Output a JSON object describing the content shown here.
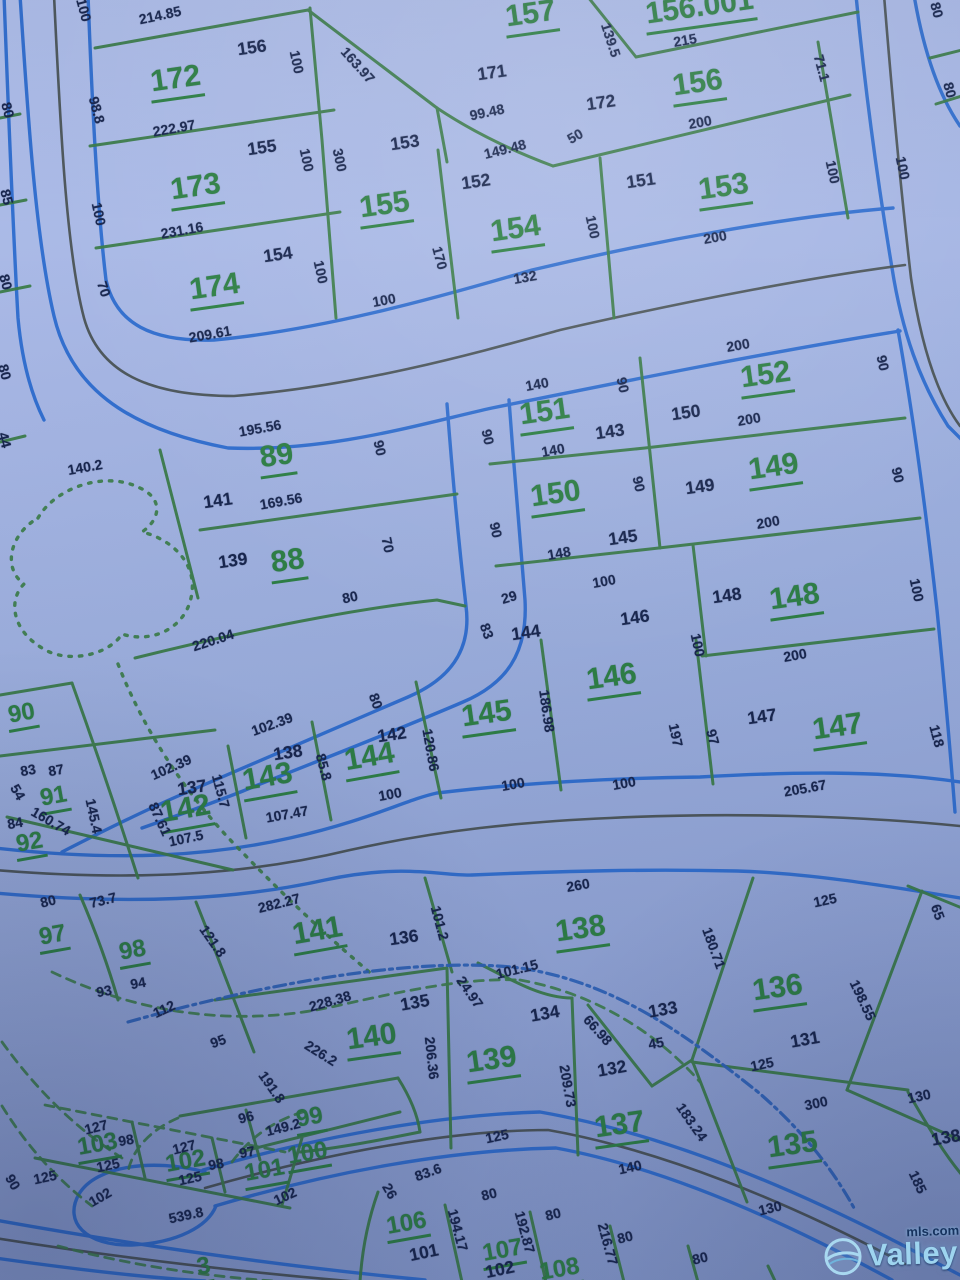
{
  "map": {
    "colors": {
      "background": "#9cafde",
      "lot_line_green": "#3b7c49",
      "road_edge_blue": "#2d6cce",
      "road_centerline_dark": "#454e4d",
      "creek_blue": "#2e63b8",
      "lot_text_green": "#2e8045",
      "dim_text_navy": "#18264e"
    },
    "lots": [
      {
        "t": "172",
        "x": 176,
        "y": 82,
        "r": -8
      },
      {
        "t": "173",
        "x": 196,
        "y": 190,
        "r": -8
      },
      {
        "t": "174",
        "x": 215,
        "y": 290,
        "r": -8
      },
      {
        "t": "155",
        "x": 385,
        "y": 208,
        "r": -8
      },
      {
        "t": "154",
        "x": 516,
        "y": 232,
        "r": -8
      },
      {
        "t": "157",
        "x": 531,
        "y": 17,
        "r": -8
      },
      {
        "t": "156.001",
        "x": 700,
        "y": 10,
        "r": -8
      },
      {
        "t": "156",
        "x": 698,
        "y": 86,
        "r": -8
      },
      {
        "t": "153",
        "x": 724,
        "y": 190,
        "r": -8
      },
      {
        "t": "152",
        "x": 766,
        "y": 378,
        "r": -8
      },
      {
        "t": "151",
        "x": 545,
        "y": 415,
        "r": -8
      },
      {
        "t": "150",
        "x": 556,
        "y": 497,
        "r": -8
      },
      {
        "t": "149",
        "x": 774,
        "y": 470,
        "r": -8
      },
      {
        "t": "148",
        "x": 795,
        "y": 600,
        "r": -8
      },
      {
        "t": "147",
        "x": 838,
        "y": 730,
        "r": -8
      },
      {
        "t": "146",
        "x": 612,
        "y": 680,
        "r": -8
      },
      {
        "t": "145",
        "x": 487,
        "y": 717,
        "r": -8
      },
      {
        "t": "144",
        "x": 370,
        "y": 760,
        "r": -10
      },
      {
        "t": "143",
        "x": 268,
        "y": 780,
        "r": -10
      },
      {
        "t": "142",
        "x": 186,
        "y": 812,
        "r": -10
      },
      {
        "t": "89",
        "x": 277,
        "y": 459,
        "r": -8
      },
      {
        "t": "88",
        "x": 288,
        "y": 564,
        "r": -8
      },
      {
        "t": "90",
        "x": 22,
        "y": 716,
        "r": -10,
        "s": 1
      },
      {
        "t": "91",
        "x": 54,
        "y": 799,
        "r": -10,
        "s": 1
      },
      {
        "t": "92",
        "x": 30,
        "y": 845,
        "r": -10,
        "s": 1
      },
      {
        "t": "97",
        "x": 53,
        "y": 938,
        "r": -10,
        "s": 1
      },
      {
        "t": "98",
        "x": 133,
        "y": 953,
        "r": -10,
        "s": 1
      },
      {
        "t": "99",
        "x": 310,
        "y": 1120,
        "r": -10,
        "s": 1
      },
      {
        "t": "141",
        "x": 318,
        "y": 934,
        "r": -10
      },
      {
        "t": "138",
        "x": 581,
        "y": 932,
        "r": -8
      },
      {
        "t": "140",
        "x": 372,
        "y": 1040,
        "r": -8
      },
      {
        "t": "139",
        "x": 492,
        "y": 1063,
        "r": -8
      },
      {
        "t": "137",
        "x": 620,
        "y": 1128,
        "r": -8
      },
      {
        "t": "136",
        "x": 778,
        "y": 991,
        "r": -8
      },
      {
        "t": "135",
        "x": 793,
        "y": 1148,
        "r": -8
      },
      {
        "t": "100",
        "x": 308,
        "y": 1156,
        "r": -10,
        "s": 1
      },
      {
        "t": "101",
        "x": 265,
        "y": 1173,
        "r": -10,
        "s": 1
      },
      {
        "t": "102",
        "x": 186,
        "y": 1164,
        "r": -10,
        "s": 1
      },
      {
        "t": "103",
        "x": 98,
        "y": 1147,
        "r": -10,
        "s": 1
      },
      {
        "t": "106",
        "x": 407,
        "y": 1226,
        "r": -10,
        "s": 1
      },
      {
        "t": "107",
        "x": 503,
        "y": 1253,
        "r": -10,
        "s": 1
      },
      {
        "t": "108",
        "x": 560,
        "y": 1272,
        "r": -10,
        "s": 1
      },
      {
        "t": "3",
        "x": 204,
        "y": 1269,
        "r": -10,
        "s": 1
      }
    ],
    "dims": [
      {
        "t": "214.85",
        "x": 160,
        "y": 15,
        "r": -12
      },
      {
        "t": "156",
        "x": 252,
        "y": 48,
        "r": -8,
        "b": 1
      },
      {
        "t": "100",
        "x": 297,
        "y": 62,
        "r": 78
      },
      {
        "t": "98.8",
        "x": 97,
        "y": 110,
        "r": 75
      },
      {
        "t": "163.97",
        "x": 358,
        "y": 65,
        "r": 48
      },
      {
        "t": "222.97",
        "x": 174,
        "y": 128,
        "r": -10
      },
      {
        "t": "155",
        "x": 262,
        "y": 148,
        "r": -8,
        "b": 1
      },
      {
        "t": "100",
        "x": 307,
        "y": 160,
        "r": 78
      },
      {
        "t": "300",
        "x": 340,
        "y": 160,
        "r": 78
      },
      {
        "t": "153",
        "x": 405,
        "y": 143,
        "r": -8,
        "b": 1
      },
      {
        "t": "231.16",
        "x": 182,
        "y": 230,
        "r": -10
      },
      {
        "t": "154",
        "x": 278,
        "y": 255,
        "r": -8,
        "b": 1
      },
      {
        "t": "100",
        "x": 99,
        "y": 214,
        "r": 78
      },
      {
        "t": "100",
        "x": 321,
        "y": 272,
        "r": 78
      },
      {
        "t": "70",
        "x": 104,
        "y": 289,
        "r": 72
      },
      {
        "t": "209.61",
        "x": 210,
        "y": 334,
        "r": -10
      },
      {
        "t": "171",
        "x": 492,
        "y": 73,
        "r": -8,
        "b": 1
      },
      {
        "t": "139.5",
        "x": 611,
        "y": 40,
        "r": 72
      },
      {
        "t": "215",
        "x": 685,
        "y": 40,
        "r": -10
      },
      {
        "t": "99.48",
        "x": 487,
        "y": 112,
        "r": -12
      },
      {
        "t": "172",
        "x": 601,
        "y": 103,
        "r": -8,
        "b": 1
      },
      {
        "t": "200",
        "x": 700,
        "y": 122,
        "r": -10
      },
      {
        "t": "71.1",
        "x": 822,
        "y": 68,
        "r": 75
      },
      {
        "t": "50",
        "x": 575,
        "y": 136,
        "r": -30
      },
      {
        "t": "149.48",
        "x": 505,
        "y": 149,
        "r": -14
      },
      {
        "t": "152",
        "x": 476,
        "y": 182,
        "r": -8,
        "b": 1
      },
      {
        "t": "151",
        "x": 641,
        "y": 181,
        "r": -8,
        "b": 1
      },
      {
        "t": "100",
        "x": 593,
        "y": 227,
        "r": 78
      },
      {
        "t": "100",
        "x": 833,
        "y": 172,
        "r": 78
      },
      {
        "t": "100",
        "x": 903,
        "y": 168,
        "r": 78
      },
      {
        "t": "200",
        "x": 715,
        "y": 237,
        "r": -10
      },
      {
        "t": "170",
        "x": 440,
        "y": 258,
        "r": 75
      },
      {
        "t": "132",
        "x": 525,
        "y": 277,
        "r": -10
      },
      {
        "t": "100",
        "x": 384,
        "y": 300,
        "r": -10
      },
      {
        "t": "80",
        "x": 937,
        "y": 10,
        "r": 75
      },
      {
        "t": "80",
        "x": 950,
        "y": 90,
        "r": 75
      },
      {
        "t": "80",
        "x": 8,
        "y": 110,
        "r": 75
      },
      {
        "t": "85",
        "x": 7,
        "y": 197,
        "r": 75
      },
      {
        "t": "80",
        "x": 6,
        "y": 282,
        "r": 75
      },
      {
        "t": "100",
        "x": 84,
        "y": 10,
        "r": 75
      },
      {
        "t": "80",
        "x": 5,
        "y": 372,
        "r": 75
      },
      {
        "t": "44",
        "x": 5,
        "y": 440,
        "r": 75
      },
      {
        "t": "140.2",
        "x": 85,
        "y": 467,
        "r": -10
      },
      {
        "t": "195.56",
        "x": 260,
        "y": 428,
        "r": -10
      },
      {
        "t": "90",
        "x": 380,
        "y": 448,
        "r": 78
      },
      {
        "t": "141",
        "x": 218,
        "y": 501,
        "r": -8,
        "b": 1
      },
      {
        "t": "169.56",
        "x": 281,
        "y": 501,
        "r": -10
      },
      {
        "t": "139",
        "x": 233,
        "y": 561,
        "r": -8,
        "b": 1
      },
      {
        "t": "70",
        "x": 388,
        "y": 545,
        "r": 78
      },
      {
        "t": "80",
        "x": 350,
        "y": 597,
        "r": -12
      },
      {
        "t": "220.04",
        "x": 213,
        "y": 640,
        "r": -18
      },
      {
        "t": "140",
        "x": 537,
        "y": 384,
        "r": -10
      },
      {
        "t": "90",
        "x": 623,
        "y": 385,
        "r": 78
      },
      {
        "t": "200",
        "x": 738,
        "y": 345,
        "r": -10
      },
      {
        "t": "90",
        "x": 883,
        "y": 363,
        "r": 78
      },
      {
        "t": "150",
        "x": 686,
        "y": 413,
        "r": -8,
        "b": 1
      },
      {
        "t": "143",
        "x": 610,
        "y": 432,
        "r": -8,
        "b": 1
      },
      {
        "t": "90",
        "x": 488,
        "y": 437,
        "r": 78
      },
      {
        "t": "140",
        "x": 553,
        "y": 450,
        "r": -10
      },
      {
        "t": "200",
        "x": 749,
        "y": 419,
        "r": -10
      },
      {
        "t": "90",
        "x": 898,
        "y": 475,
        "r": 78
      },
      {
        "t": "149",
        "x": 700,
        "y": 487,
        "r": -8,
        "b": 1
      },
      {
        "t": "90",
        "x": 639,
        "y": 484,
        "r": 78
      },
      {
        "t": "90",
        "x": 496,
        "y": 530,
        "r": 78
      },
      {
        "t": "200",
        "x": 768,
        "y": 522,
        "r": -10
      },
      {
        "t": "148",
        "x": 559,
        "y": 553,
        "r": -10
      },
      {
        "t": "145",
        "x": 623,
        "y": 538,
        "r": -8,
        "b": 1
      },
      {
        "t": "100",
        "x": 604,
        "y": 581,
        "r": -10
      },
      {
        "t": "146",
        "x": 635,
        "y": 618,
        "r": -8,
        "b": 1
      },
      {
        "t": "148",
        "x": 727,
        "y": 596,
        "r": -8,
        "b": 1
      },
      {
        "t": "100",
        "x": 917,
        "y": 590,
        "r": 78
      },
      {
        "t": "29",
        "x": 509,
        "y": 597,
        "r": -16
      },
      {
        "t": "144",
        "x": 526,
        "y": 633,
        "r": -8,
        "b": 1
      },
      {
        "t": "83",
        "x": 487,
        "y": 631,
        "r": 70
      },
      {
        "t": "100",
        "x": 698,
        "y": 645,
        "r": 78
      },
      {
        "t": "200",
        "x": 795,
        "y": 655,
        "r": -10
      },
      {
        "t": "197",
        "x": 676,
        "y": 735,
        "r": 78
      },
      {
        "t": "97",
        "x": 713,
        "y": 737,
        "r": 75
      },
      {
        "t": "147",
        "x": 762,
        "y": 717,
        "r": -8,
        "b": 1
      },
      {
        "t": "118",
        "x": 937,
        "y": 736,
        "r": 75
      },
      {
        "t": "205.67",
        "x": 805,
        "y": 788,
        "r": -10
      },
      {
        "t": "186.98",
        "x": 547,
        "y": 711,
        "r": 82
      },
      {
        "t": "80",
        "x": 376,
        "y": 701,
        "r": 70
      },
      {
        "t": "102.39",
        "x": 272,
        "y": 724,
        "r": -20
      },
      {
        "t": "142",
        "x": 392,
        "y": 735,
        "r": -8,
        "b": 1
      },
      {
        "t": "138",
        "x": 288,
        "y": 753,
        "r": -8,
        "b": 1
      },
      {
        "t": "120.86",
        "x": 431,
        "y": 750,
        "r": 80
      },
      {
        "t": "102.39",
        "x": 171,
        "y": 767,
        "r": -24
      },
      {
        "t": "85.8",
        "x": 324,
        "y": 767,
        "r": 75
      },
      {
        "t": "137",
        "x": 192,
        "y": 788,
        "r": -8,
        "b": 1
      },
      {
        "t": "115.7",
        "x": 221,
        "y": 791,
        "r": 75
      },
      {
        "t": "87.61",
        "x": 160,
        "y": 819,
        "r": 65
      },
      {
        "t": "107.47",
        "x": 287,
        "y": 814,
        "r": -10
      },
      {
        "t": "107.5",
        "x": 186,
        "y": 838,
        "r": -12
      },
      {
        "t": "100",
        "x": 390,
        "y": 794,
        "r": -10
      },
      {
        "t": "100",
        "x": 513,
        "y": 784,
        "r": -10
      },
      {
        "t": "100",
        "x": 624,
        "y": 783,
        "r": -10
      },
      {
        "t": "83",
        "x": 28,
        "y": 770,
        "r": -10
      },
      {
        "t": "87",
        "x": 56,
        "y": 770,
        "r": -10
      },
      {
        "t": "54",
        "x": 18,
        "y": 792,
        "r": 60
      },
      {
        "t": "84",
        "x": 15,
        "y": 823,
        "r": -10
      },
      {
        "t": "160.74",
        "x": 51,
        "y": 821,
        "r": 30
      },
      {
        "t": "145.4",
        "x": 94,
        "y": 816,
        "r": 78
      },
      {
        "t": "80",
        "x": 48,
        "y": 901,
        "r": -14
      },
      {
        "t": "73.7",
        "x": 103,
        "y": 900,
        "r": -14
      },
      {
        "t": "93",
        "x": 104,
        "y": 991,
        "r": -10
      },
      {
        "t": "94",
        "x": 138,
        "y": 983,
        "r": -10
      },
      {
        "t": "112",
        "x": 164,
        "y": 1009,
        "r": -25
      },
      {
        "t": "95",
        "x": 218,
        "y": 1041,
        "r": -20
      },
      {
        "t": "121.8",
        "x": 213,
        "y": 941,
        "r": 55
      },
      {
        "t": "282.27",
        "x": 279,
        "y": 903,
        "r": -14
      },
      {
        "t": "226.2",
        "x": 321,
        "y": 1053,
        "r": 32
      },
      {
        "t": "191.8",
        "x": 272,
        "y": 1087,
        "r": 55
      },
      {
        "t": "96",
        "x": 246,
        "y": 1117,
        "r": -14
      },
      {
        "t": "149.2",
        "x": 283,
        "y": 1127,
        "r": -14
      },
      {
        "t": "127",
        "x": 96,
        "y": 1127,
        "r": -14
      },
      {
        "t": "98",
        "x": 126,
        "y": 1140,
        "r": -10
      },
      {
        "t": "127",
        "x": 184,
        "y": 1147,
        "r": -14
      },
      {
        "t": "98",
        "x": 216,
        "y": 1164,
        "r": -10
      },
      {
        "t": "97",
        "x": 247,
        "y": 1152,
        "r": -10
      },
      {
        "t": "125",
        "x": 45,
        "y": 1177,
        "r": -12
      },
      {
        "t": "125",
        "x": 108,
        "y": 1165,
        "r": -12
      },
      {
        "t": "125",
        "x": 190,
        "y": 1178,
        "r": -12
      },
      {
        "t": "102",
        "x": 100,
        "y": 1197,
        "r": -30
      },
      {
        "t": "102",
        "x": 285,
        "y": 1196,
        "r": -25
      },
      {
        "t": "90",
        "x": 13,
        "y": 1182,
        "r": 60
      },
      {
        "t": "539.8",
        "x": 186,
        "y": 1215,
        "r": -12
      },
      {
        "t": "83.6",
        "x": 428,
        "y": 1172,
        "r": -20
      },
      {
        "t": "26",
        "x": 390,
        "y": 1191,
        "r": 60
      },
      {
        "t": "101",
        "x": 424,
        "y": 1253,
        "r": -12,
        "b": 1
      },
      {
        "t": "194.17",
        "x": 458,
        "y": 1230,
        "r": 75
      },
      {
        "t": "80",
        "x": 489,
        "y": 1194,
        "r": -14
      },
      {
        "t": "80",
        "x": 553,
        "y": 1214,
        "r": -14
      },
      {
        "t": "192.87",
        "x": 525,
        "y": 1232,
        "r": 75
      },
      {
        "t": "102",
        "x": 500,
        "y": 1270,
        "r": -12,
        "b": 1
      },
      {
        "t": "216.77",
        "x": 608,
        "y": 1244,
        "r": 75
      },
      {
        "t": "80",
        "x": 625,
        "y": 1237,
        "r": -14
      },
      {
        "t": "80",
        "x": 700,
        "y": 1258,
        "r": -14
      },
      {
        "t": "125",
        "x": 497,
        "y": 1136,
        "r": -12
      },
      {
        "t": "140",
        "x": 630,
        "y": 1167,
        "r": -12
      },
      {
        "t": "130",
        "x": 770,
        "y": 1208,
        "r": -14
      },
      {
        "t": "130",
        "x": 919,
        "y": 1096,
        "r": -12
      },
      {
        "t": "125",
        "x": 825,
        "y": 900,
        "r": -12
      },
      {
        "t": "180.71",
        "x": 714,
        "y": 948,
        "r": 70
      },
      {
        "t": "198.55",
        "x": 863,
        "y": 1000,
        "r": 65
      },
      {
        "t": "133",
        "x": 663,
        "y": 1010,
        "r": -10,
        "b": 1
      },
      {
        "t": "131",
        "x": 805,
        "y": 1040,
        "r": -10,
        "b": 1
      },
      {
        "t": "45",
        "x": 656,
        "y": 1043,
        "r": -10
      },
      {
        "t": "125",
        "x": 762,
        "y": 1064,
        "r": -12
      },
      {
        "t": "300",
        "x": 816,
        "y": 1103,
        "r": -12
      },
      {
        "t": "65",
        "x": 938,
        "y": 912,
        "r": 70
      },
      {
        "t": "101.2",
        "x": 440,
        "y": 923,
        "r": 75
      },
      {
        "t": "136",
        "x": 404,
        "y": 938,
        "r": -8,
        "b": 1
      },
      {
        "t": "260",
        "x": 578,
        "y": 885,
        "r": -10
      },
      {
        "t": "101.15",
        "x": 517,
        "y": 969,
        "r": -14
      },
      {
        "t": "228.38",
        "x": 330,
        "y": 1001,
        "r": -16
      },
      {
        "t": "135",
        "x": 415,
        "y": 1003,
        "r": -10,
        "b": 1
      },
      {
        "t": "24.97",
        "x": 470,
        "y": 992,
        "r": 55
      },
      {
        "t": "134",
        "x": 545,
        "y": 1014,
        "r": -10,
        "b": 1
      },
      {
        "t": "66.98",
        "x": 598,
        "y": 1030,
        "r": 48
      },
      {
        "t": "206.36",
        "x": 432,
        "y": 1058,
        "r": 84
      },
      {
        "t": "209.73",
        "x": 568,
        "y": 1086,
        "r": 80
      },
      {
        "t": "132",
        "x": 612,
        "y": 1069,
        "r": -10,
        "b": 1
      },
      {
        "t": "183.24",
        "x": 692,
        "y": 1122,
        "r": 55
      },
      {
        "t": "185",
        "x": 918,
        "y": 1182,
        "r": 65
      },
      {
        "t": "138",
        "x": 946,
        "y": 1138,
        "r": -10,
        "b": 1
      }
    ]
  },
  "logo": {
    "name": "Valley",
    "suffix": "mls.com",
    "icon": "globe-swoosh-icon",
    "color": "#9ed4ef"
  }
}
